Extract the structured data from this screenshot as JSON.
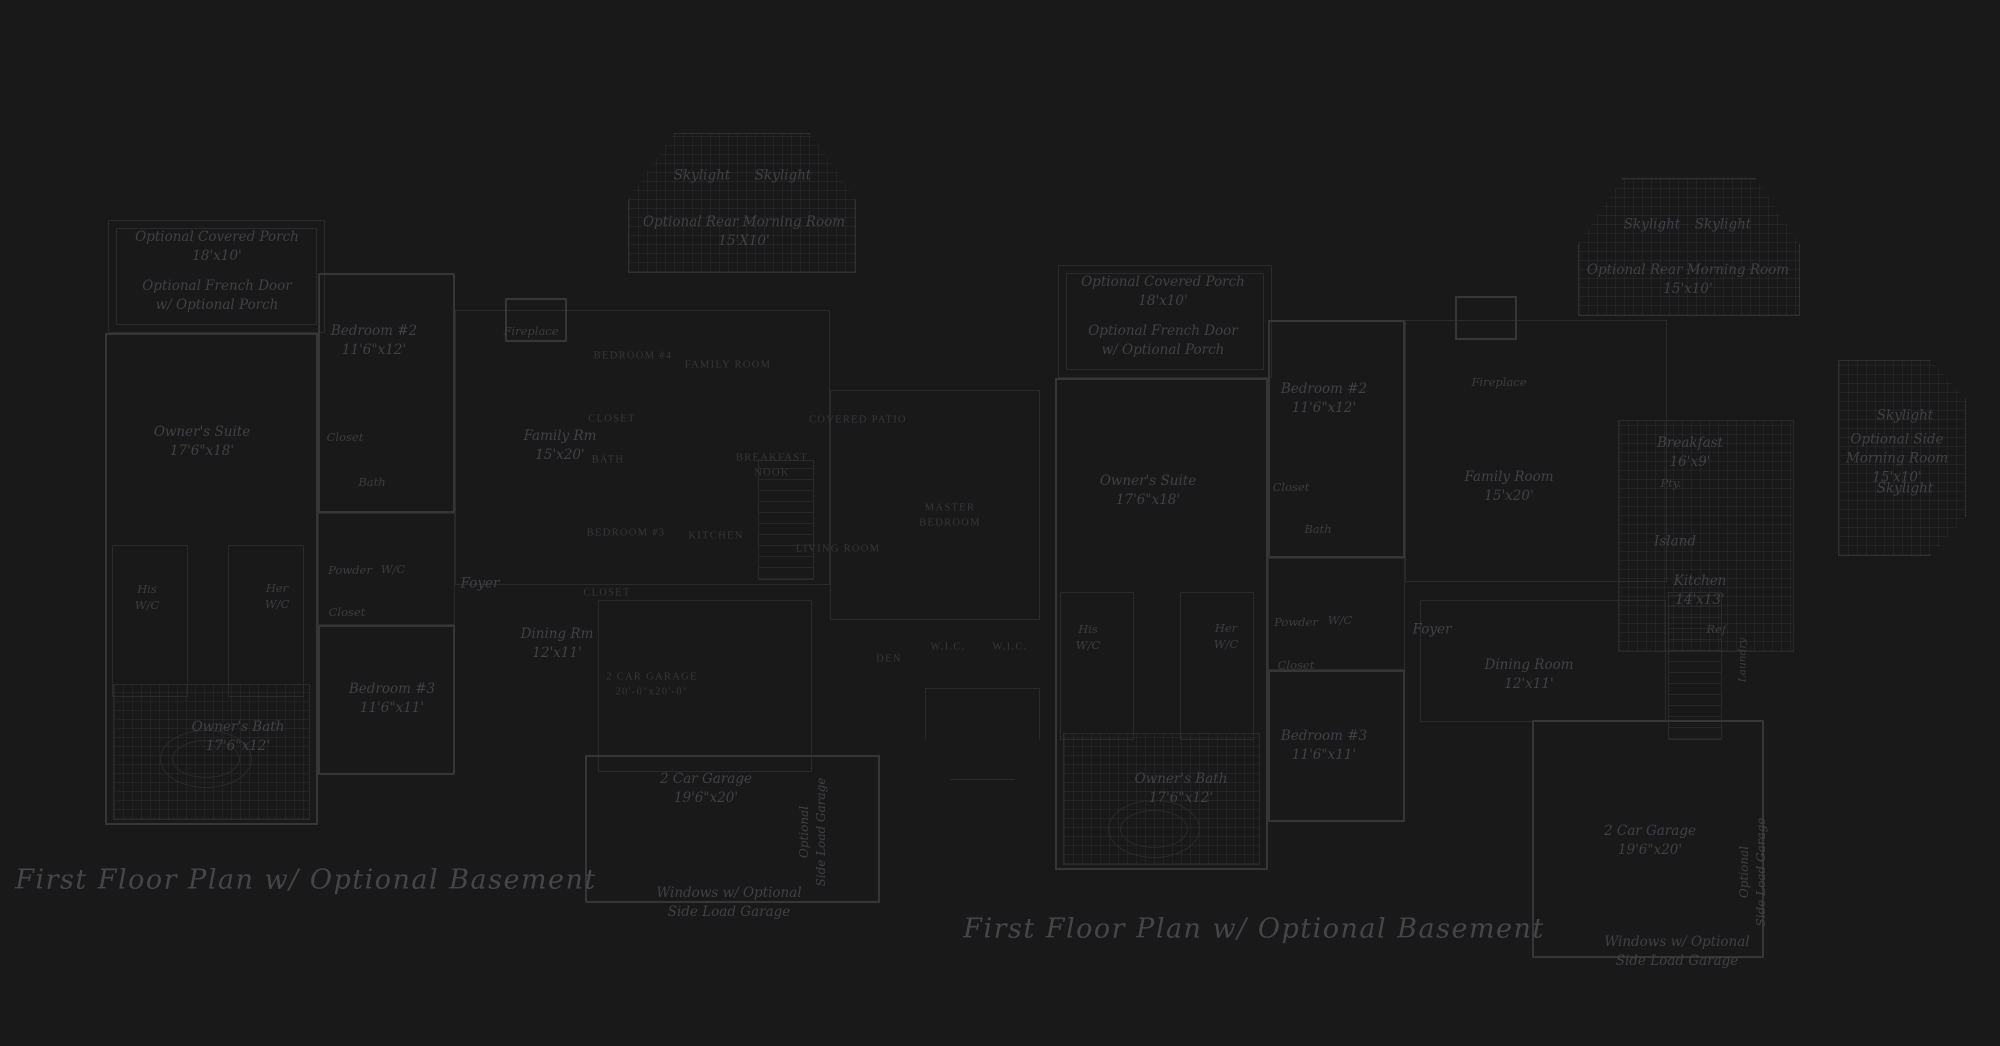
{
  "meta": {
    "background_color": "#1a1919",
    "wall_color": "#363636",
    "faint_line_color": "#2a2a2a",
    "label_color": "#414046",
    "caps_label_color": "#36363a",
    "title_color": "#45454b"
  },
  "plans": {
    "left": {
      "title": "First Floor Plan  w/ Optional Basement",
      "walls": [
        [
          "porch-outer",
          108,
          220,
          217,
          113,
          "faint"
        ],
        [
          "porch-inner",
          116,
          228,
          201,
          97,
          "faint"
        ],
        [
          "owners-suite-wing",
          105,
          333,
          213,
          492,
          "wall"
        ],
        [
          "owners-bath-tile",
          113,
          684,
          197,
          136,
          "faint grid"
        ],
        [
          "bedroom2",
          318,
          273,
          137,
          240,
          "wall"
        ],
        [
          "closet-strip",
          318,
          513,
          137,
          112,
          "faint"
        ],
        [
          "bedroom3",
          318,
          625,
          137,
          150,
          "wall"
        ],
        [
          "morning-room",
          628,
          133,
          228,
          140,
          "grid octtop"
        ],
        [
          "center-block",
          455,
          310,
          375,
          275,
          "faint"
        ],
        [
          "fireplace",
          505,
          298,
          62,
          44,
          "wall"
        ],
        [
          "caps-garage",
          598,
          600,
          214,
          172,
          "faint"
        ],
        [
          "garage",
          585,
          755,
          295,
          148,
          "wall"
        ],
        [
          "right-wing",
          830,
          390,
          210,
          230,
          "faint"
        ],
        [
          "bay-window",
          925,
          688,
          115,
          92,
          "faint octbot"
        ],
        [
          "his-wc",
          112,
          545,
          76,
          152,
          "faint"
        ],
        [
          "her-wc",
          228,
          545,
          76,
          152,
          "faint"
        ],
        [
          "stairs",
          758,
          460,
          56,
          120,
          "hatch"
        ],
        [
          "tub",
          160,
          730,
          92,
          58,
          "faint ellipse"
        ],
        [
          "tub-basin",
          172,
          740,
          68,
          38,
          "inner-ellipse"
        ]
      ],
      "labels": [
        {
          "lines": [
            "Optional Covered Porch",
            "18'x10'"
          ],
          "x": 217,
          "y": 247,
          "s": "it"
        },
        {
          "lines": [
            "Optional French Door",
            "w/ Optional Porch"
          ],
          "x": 217,
          "y": 296,
          "s": "it"
        },
        {
          "lines": [
            "Bedroom #2",
            "11'6\"x12'"
          ],
          "x": 374,
          "y": 341,
          "s": "it"
        },
        {
          "lines": [
            "Closet"
          ],
          "x": 345,
          "y": 437,
          "s": "its"
        },
        {
          "lines": [
            "Bath"
          ],
          "x": 372,
          "y": 482,
          "s": "its"
        },
        {
          "lines": [
            "Owner's Suite",
            "17'6\"x18'"
          ],
          "x": 202,
          "y": 442,
          "s": "it"
        },
        {
          "lines": [
            "His",
            "W/C"
          ],
          "x": 147,
          "y": 597,
          "s": "its"
        },
        {
          "lines": [
            "Her",
            "W/C"
          ],
          "x": 277,
          "y": 596,
          "s": "its"
        },
        {
          "lines": [
            "Powder"
          ],
          "x": 350,
          "y": 570,
          "s": "its"
        },
        {
          "lines": [
            "W/C"
          ],
          "x": 393,
          "y": 569,
          "s": "its"
        },
        {
          "lines": [
            "Closet"
          ],
          "x": 347,
          "y": 612,
          "s": "its"
        },
        {
          "lines": [
            "Bedroom #3",
            "11'6\"x11'"
          ],
          "x": 392,
          "y": 699,
          "s": "it"
        },
        {
          "lines": [
            "Owner's Bath",
            "17'6\"x12'"
          ],
          "x": 238,
          "y": 737,
          "s": "it"
        },
        {
          "lines": [
            "Skylight"
          ],
          "x": 702,
          "y": 176,
          "s": "it"
        },
        {
          "lines": [
            "Skylight"
          ],
          "x": 783,
          "y": 176,
          "s": "it"
        },
        {
          "lines": [
            "Optional Rear Morning Room",
            "15'X10'"
          ],
          "x": 744,
          "y": 232,
          "s": "it"
        },
        {
          "lines": [
            "Fireplace"
          ],
          "x": 531,
          "y": 331,
          "s": "its"
        },
        {
          "lines": [
            "Family Rm",
            "15'x20'"
          ],
          "x": 560,
          "y": 446,
          "s": "it"
        },
        {
          "lines": [
            "Foyer"
          ],
          "x": 480,
          "y": 584,
          "s": "it"
        },
        {
          "lines": [
            "Dining Rm",
            "12'x11'"
          ],
          "x": 557,
          "y": 644,
          "s": "it"
        },
        {
          "lines": [
            "2 Car Garage",
            "19'6\"x20'"
          ],
          "x": 706,
          "y": 789,
          "s": "it"
        },
        {
          "lines": [
            "Optional",
            "Side Load Garage"
          ],
          "x": 813,
          "y": 832,
          "s": "vert"
        },
        {
          "lines": [
            "Windows w/ Optional",
            "Side Load Garage"
          ],
          "x": 729,
          "y": 903,
          "s": "it"
        }
      ]
    },
    "overlay": {
      "walls": [],
      "labels": [
        {
          "lines": [
            "BEDROOM #4"
          ],
          "x": 633,
          "y": 357,
          "s": "caps"
        },
        {
          "lines": [
            "CLOSET"
          ],
          "x": 612,
          "y": 420,
          "s": "caps"
        },
        {
          "lines": [
            "BATH"
          ],
          "x": 608,
          "y": 461,
          "s": "caps"
        },
        {
          "lines": [
            "BEDROOM #3"
          ],
          "x": 626,
          "y": 534,
          "s": "caps"
        },
        {
          "lines": [
            "CLOSET"
          ],
          "x": 607,
          "y": 594,
          "s": "caps"
        },
        {
          "lines": [
            "FAMILY ROOM"
          ],
          "x": 728,
          "y": 366,
          "s": "caps"
        },
        {
          "lines": [
            "COVERED PATIO"
          ],
          "x": 858,
          "y": 421,
          "s": "caps"
        },
        {
          "lines": [
            "BREAKFAST",
            "NOOK"
          ],
          "x": 772,
          "y": 466,
          "s": "caps"
        },
        {
          "lines": [
            "KITCHEN"
          ],
          "x": 716,
          "y": 537,
          "s": "caps"
        },
        {
          "lines": [
            "LIVING ROOM"
          ],
          "x": 838,
          "y": 550,
          "s": "caps"
        },
        {
          "lines": [
            "MASTER",
            "BEDROOM"
          ],
          "x": 950,
          "y": 516,
          "s": "caps"
        },
        {
          "lines": [
            "DEN"
          ],
          "x": 889,
          "y": 660,
          "s": "caps"
        },
        {
          "lines": [
            "W.I.C."
          ],
          "x": 948,
          "y": 648,
          "s": "caps"
        },
        {
          "lines": [
            "W.I.C."
          ],
          "x": 1010,
          "y": 648,
          "s": "caps"
        },
        {
          "lines": [
            "2 CAR GARAGE",
            "20'-0\"x20'-0\""
          ],
          "x": 652,
          "y": 685,
          "s": "caps"
        }
      ]
    },
    "right": {
      "title": "First Floor Plan  w/ Optional Basement",
      "walls": [
        [
          "porch-outer",
          1058,
          265,
          214,
          113,
          "faint"
        ],
        [
          "porch-inner",
          1066,
          273,
          198,
          97,
          "faint"
        ],
        [
          "owners-suite-wing",
          1055,
          378,
          213,
          492,
          "wall"
        ],
        [
          "owners-bath-tile",
          1063,
          733,
          197,
          132,
          "faint grid"
        ],
        [
          "bedroom2",
          1268,
          320,
          137,
          238,
          "wall"
        ],
        [
          "closet-strip",
          1268,
          558,
          137,
          112,
          "faint"
        ],
        [
          "bedroom3",
          1268,
          670,
          137,
          152,
          "wall"
        ],
        [
          "morning-room",
          1578,
          178,
          222,
          138,
          "grid octtop"
        ],
        [
          "family-room",
          1405,
          320,
          262,
          262,
          "faint"
        ],
        [
          "fireplace",
          1455,
          296,
          62,
          44,
          "wall"
        ],
        [
          "kitchen-tile",
          1618,
          420,
          176,
          232,
          "faint grid"
        ],
        [
          "side-morning-room",
          1838,
          360,
          128,
          196,
          "grid octside"
        ],
        [
          "dining-room",
          1420,
          600,
          246,
          122,
          "faint"
        ],
        [
          "stairs",
          1668,
          592,
          54,
          148,
          "hatch"
        ],
        [
          "garage",
          1532,
          720,
          232,
          238,
          "wall"
        ],
        [
          "his-wc",
          1060,
          592,
          74,
          148,
          "faint"
        ],
        [
          "her-wc",
          1180,
          592,
          74,
          148,
          "faint"
        ],
        [
          "tub",
          1108,
          800,
          92,
          58,
          "faint ellipse"
        ],
        [
          "tub-basin",
          1120,
          810,
          68,
          38,
          "inner-ellipse"
        ]
      ],
      "labels": [
        {
          "lines": [
            "Optional Covered Porch",
            "18'x10'"
          ],
          "x": 1163,
          "y": 292,
          "s": "it"
        },
        {
          "lines": [
            "Optional French Door",
            "w/ Optional Porch"
          ],
          "x": 1163,
          "y": 341,
          "s": "it"
        },
        {
          "lines": [
            "Bedroom #2",
            "11'6\"x12'"
          ],
          "x": 1324,
          "y": 399,
          "s": "it"
        },
        {
          "lines": [
            "Closet"
          ],
          "x": 1291,
          "y": 487,
          "s": "its"
        },
        {
          "lines": [
            "Bath"
          ],
          "x": 1318,
          "y": 529,
          "s": "its"
        },
        {
          "lines": [
            "Owner's Suite",
            "17'6\"x18'"
          ],
          "x": 1148,
          "y": 491,
          "s": "it"
        },
        {
          "lines": [
            "His",
            "W/C"
          ],
          "x": 1088,
          "y": 637,
          "s": "its"
        },
        {
          "lines": [
            "Her",
            "W/C"
          ],
          "x": 1226,
          "y": 636,
          "s": "its"
        },
        {
          "lines": [
            "Powder"
          ],
          "x": 1296,
          "y": 622,
          "s": "its"
        },
        {
          "lines": [
            "W/C"
          ],
          "x": 1340,
          "y": 620,
          "s": "its"
        },
        {
          "lines": [
            "Closet"
          ],
          "x": 1296,
          "y": 665,
          "s": "its"
        },
        {
          "lines": [
            "Bedroom #3",
            "11'6\"x11'"
          ],
          "x": 1324,
          "y": 746,
          "s": "it"
        },
        {
          "lines": [
            "Owner's Bath",
            "17'6\"x12'"
          ],
          "x": 1181,
          "y": 789,
          "s": "it"
        },
        {
          "lines": [
            "Skylight"
          ],
          "x": 1652,
          "y": 225,
          "s": "it"
        },
        {
          "lines": [
            "Skylight"
          ],
          "x": 1723,
          "y": 225,
          "s": "it"
        },
        {
          "lines": [
            "Optional Rear Morning Room",
            "15'x10'"
          ],
          "x": 1688,
          "y": 280,
          "s": "it"
        },
        {
          "lines": [
            "Fireplace"
          ],
          "x": 1499,
          "y": 382,
          "s": "its"
        },
        {
          "lines": [
            "Family Room",
            "15'x20'"
          ],
          "x": 1509,
          "y": 487,
          "s": "it"
        },
        {
          "lines": [
            "Foyer"
          ],
          "x": 1432,
          "y": 630,
          "s": "it"
        },
        {
          "lines": [
            "Dining Room",
            "12'x11'"
          ],
          "x": 1529,
          "y": 675,
          "s": "it"
        },
        {
          "lines": [
            "Breakfast",
            "16'x9'"
          ],
          "x": 1690,
          "y": 453,
          "s": "it"
        },
        {
          "lines": [
            "Pty."
          ],
          "x": 1671,
          "y": 483,
          "s": "its"
        },
        {
          "lines": [
            "Island"
          ],
          "x": 1675,
          "y": 542,
          "s": "it"
        },
        {
          "lines": [
            "Kitchen",
            "14'x13'"
          ],
          "x": 1700,
          "y": 591,
          "s": "it"
        },
        {
          "lines": [
            "Ref."
          ],
          "x": 1718,
          "y": 629,
          "s": "its"
        },
        {
          "lines": [
            "Laundry"
          ],
          "x": 1743,
          "y": 660,
          "s": "verts"
        },
        {
          "lines": [
            "Skylight"
          ],
          "x": 1905,
          "y": 416,
          "s": "it"
        },
        {
          "lines": [
            "Optional Side",
            "Morning Room",
            "15'x10'"
          ],
          "x": 1897,
          "y": 459,
          "s": "it"
        },
        {
          "lines": [
            "Skylight"
          ],
          "x": 1905,
          "y": 489,
          "s": "it"
        },
        {
          "lines": [
            "2 Car Garage",
            "19'6\"x20'"
          ],
          "x": 1650,
          "y": 841,
          "s": "it"
        },
        {
          "lines": [
            "Optional",
            "Side Load Garage"
          ],
          "x": 1753,
          "y": 872,
          "s": "vert"
        },
        {
          "lines": [
            "Windows w/ Optional",
            "Side Load Garage"
          ],
          "x": 1677,
          "y": 952,
          "s": "it"
        }
      ]
    }
  }
}
